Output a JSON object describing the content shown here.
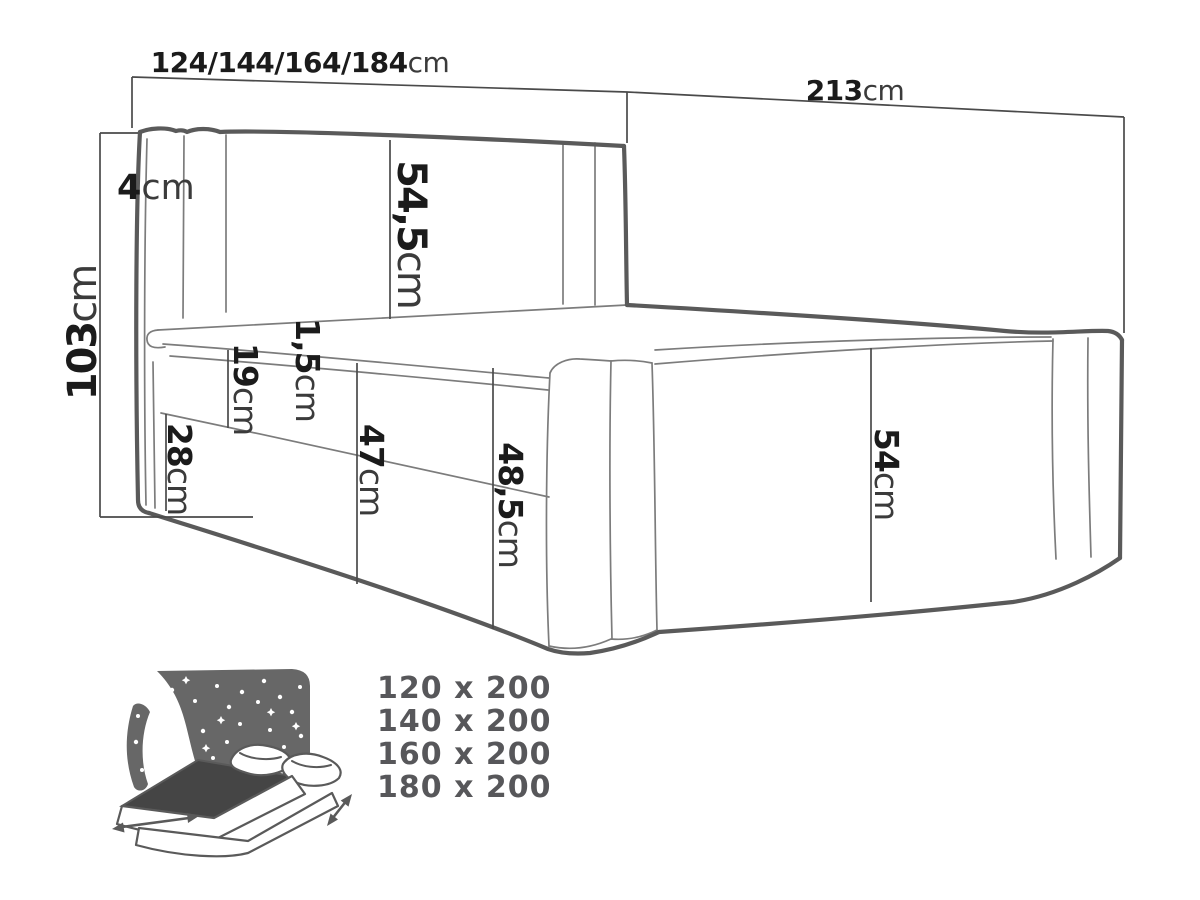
{
  "diagram": {
    "dimensions": {
      "headboard_width": {
        "value": "124/144/164/184",
        "unit": "cm"
      },
      "length": {
        "value": "213",
        "unit": "cm"
      },
      "height": {
        "value": "103",
        "unit": "cm"
      },
      "headboard_side": {
        "value": "4",
        "unit": "cm"
      },
      "headboard_panel": {
        "value": "54,5",
        "unit": "cm"
      },
      "mattress_lip": {
        "value": "1,5",
        "unit": "cm"
      },
      "mattress_band": {
        "value": "19",
        "unit": "cm"
      },
      "base_band": {
        "value": "28",
        "unit": "cm"
      },
      "side_front": {
        "value": "47",
        "unit": "cm"
      },
      "side_total": {
        "value": "48,5",
        "unit": "cm"
      },
      "foot_panel": {
        "value": "54",
        "unit": "cm"
      }
    }
  },
  "size_options": {
    "items": [
      "120 x 200",
      "140 x 200",
      "160 x 200",
      "180 x 200"
    ]
  },
  "colors": {
    "line": "#5a5a5a",
    "thin_line": "#7c7c7c",
    "dimension_line": "#4a4a4a",
    "label": "#1b1b1b",
    "unit": "#3b3b3b",
    "size_text": "#57575a",
    "icon_gray": "#676767",
    "icon_dark": "#454545",
    "background": "#ffffff"
  }
}
